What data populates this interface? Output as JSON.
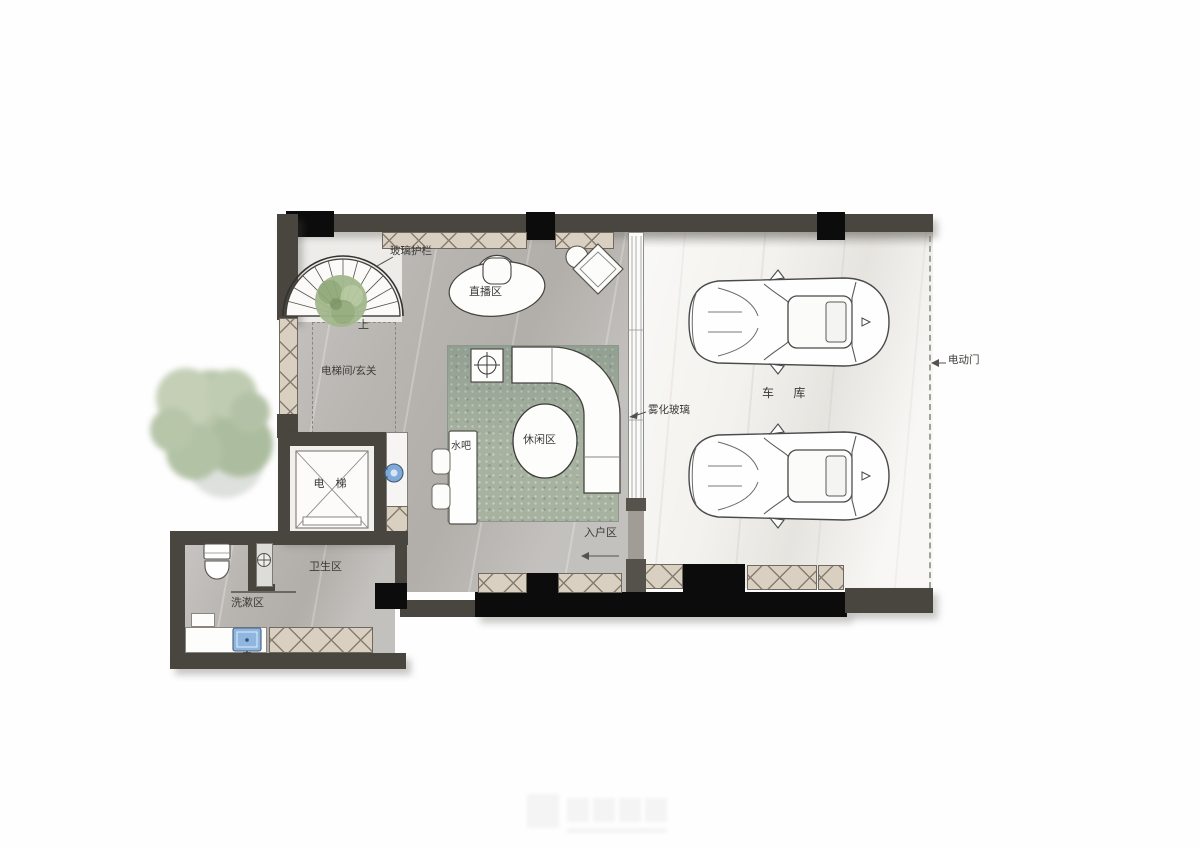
{
  "plan": {
    "labels": {
      "glass_railing": "玻璃护栏",
      "live_area": "直播区",
      "up": "上",
      "elevator_hall": "电梯间/玄关",
      "water_bar": "水吧",
      "lounge": "休闲区",
      "fog_glass": "雾化玻璃",
      "entry": "入户区",
      "garage": "车 库",
      "electric_door": "电动门",
      "elevator": "电 梯",
      "sanitary": "卫生区",
      "wash": "洗漱区"
    },
    "colors": {
      "wall": "#49463f",
      "column": "#0c0c0c",
      "cabinet_hatch": "#d9d0c1",
      "floor_main": "#b8b5b1",
      "floor_garage": "#f3f2ee",
      "rug": "#a7b2a1",
      "tree": "#b6c4a7",
      "plant": "#a3b88e",
      "sink_blue": "#8fb6e0",
      "device_blue": "#7fa9d8",
      "label_text": "#3c3a37"
    },
    "objects": [
      "spiral-staircase",
      "tree",
      "center-plant",
      "cloud-desk",
      "desk-chair",
      "stool",
      "lounge-chair",
      "curved-sofa",
      "round-table",
      "side-table",
      "water-bar-counter",
      "bar-chairs",
      "elevator-cab",
      "toilet",
      "wash-basin",
      "car",
      "car",
      "electric-door-dashed-line",
      "fog-glass-partition"
    ]
  }
}
